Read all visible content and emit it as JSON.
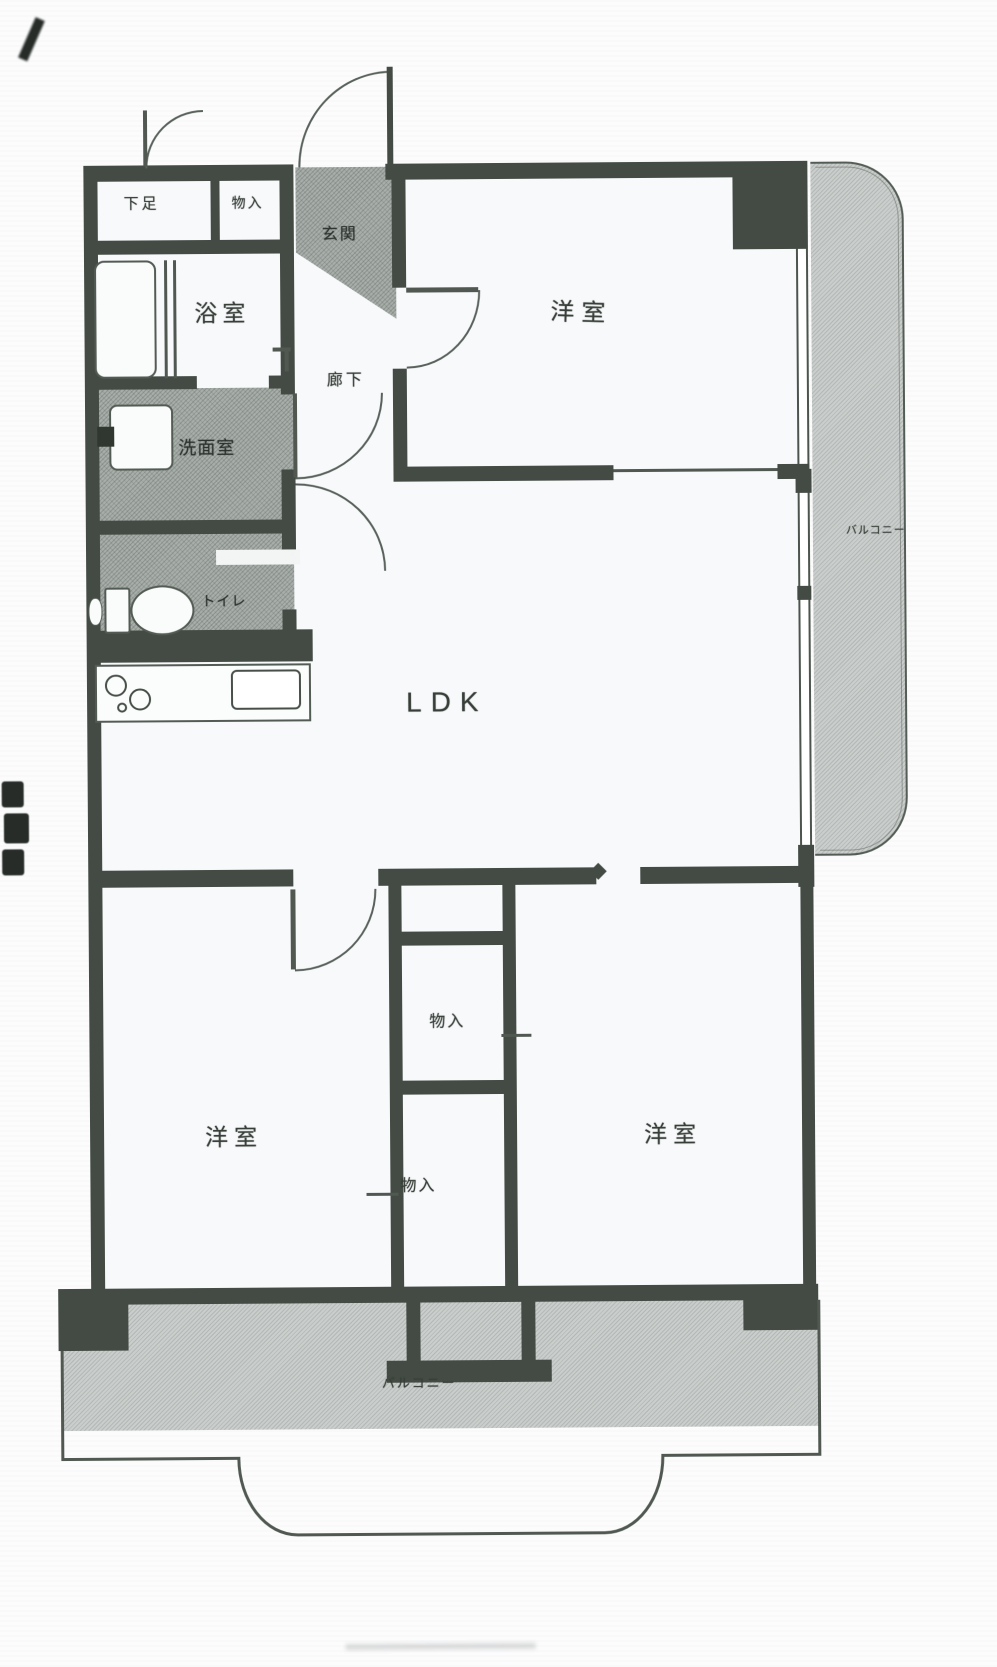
{
  "colors": {
    "wall": "#454d46",
    "line": "#4e564f",
    "shade_service": "#a6aca8",
    "shade_balcony": "#c7cbc9",
    "room_fill": "#f3f4f6",
    "text": "#3a413b"
  },
  "floorplan": {
    "rooms": {
      "shoe_closet": "下足",
      "entry_storage": "物入",
      "entrance": "玄関",
      "bath": "浴室",
      "hallway": "廊下",
      "washroom": "洗面室",
      "toilet": "トイレ",
      "bedroom_top_right": "洋室",
      "living": "LDK",
      "balcony_right": "バルコニー",
      "storage_upper": "物入",
      "storage_lower": "物入",
      "bedroom_bottom_left": "洋室",
      "bedroom_bottom_right": "洋室",
      "balcony_bottom": "バルコニー"
    }
  }
}
